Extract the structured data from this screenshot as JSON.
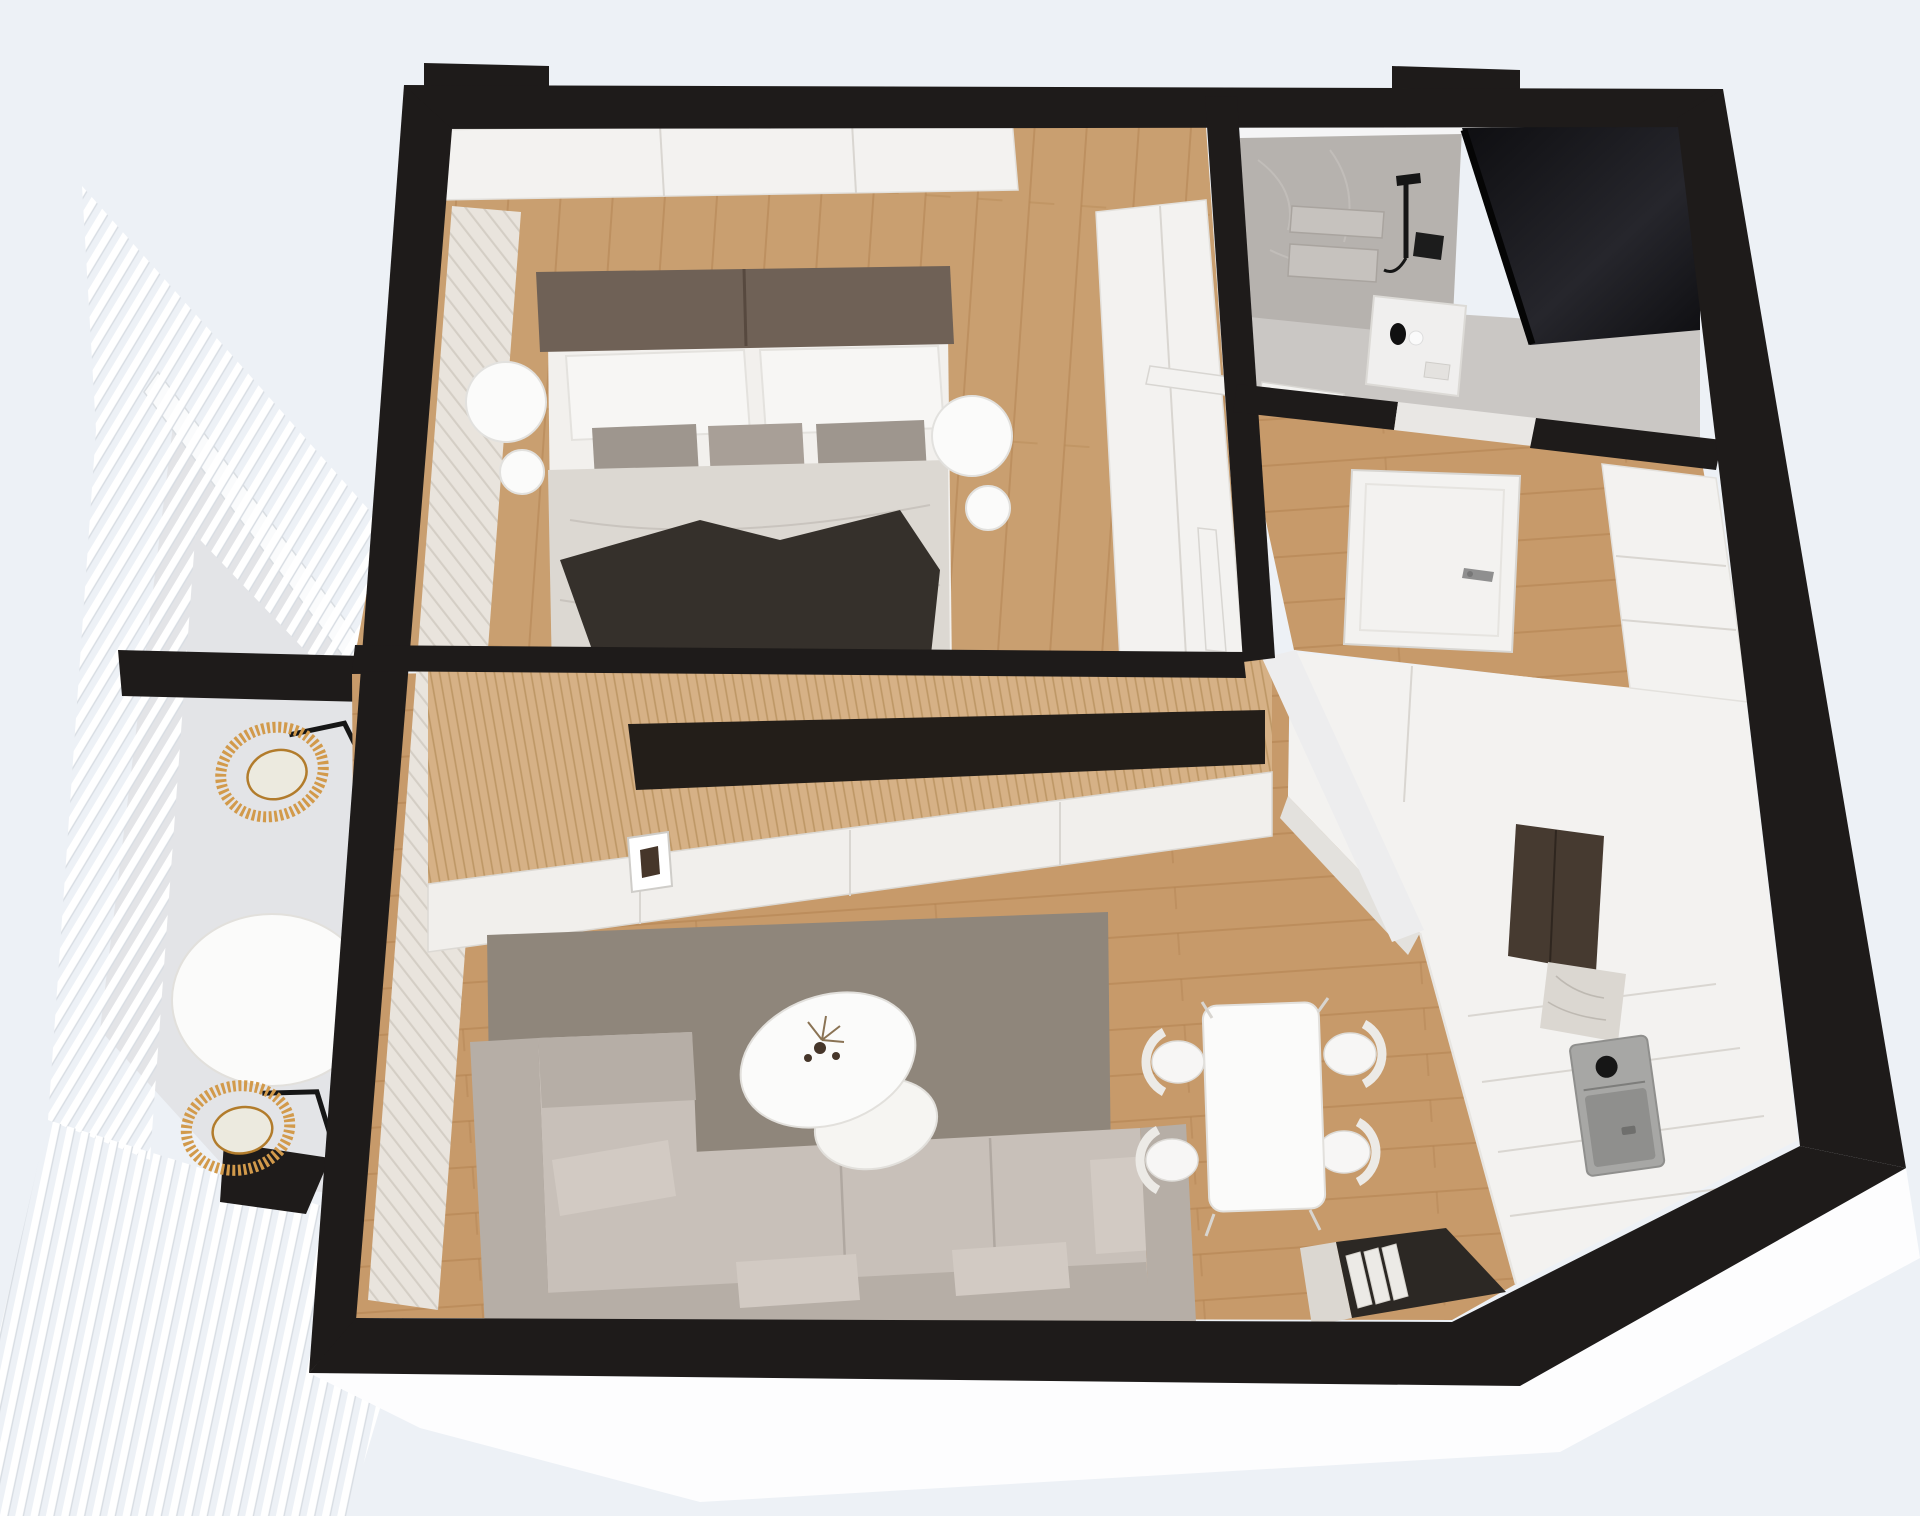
{
  "scene": {
    "kind": "3d-floor-plan-render",
    "view": "top-down axonometric",
    "apartment": "one-bedroom apartment with balcony"
  },
  "rooms": [
    {
      "id": "bedroom",
      "label": "Bedroom",
      "furniture": [
        "double-bed",
        "headboard",
        "white-pillows",
        "gray-pillows",
        "duvet",
        "dark-throw-blanket",
        "nightstand-left",
        "nightstand-right",
        "wardrobe-top-run",
        "wardrobe-side-column",
        "curtain"
      ]
    },
    {
      "id": "living-room",
      "label": "Living room",
      "furniture": [
        "corner-sofa",
        "area-rug",
        "organic-coffee-table",
        "dried-flower-decor",
        "wood-slat-tv-wall",
        "tv-niche",
        "tv-sideboard",
        "art-print"
      ]
    },
    {
      "id": "dining-area",
      "label": "Dining area",
      "furniture": [
        "dining-table",
        "dining-chair",
        "dining-chair",
        "dining-chair",
        "dining-chair"
      ]
    },
    {
      "id": "kitchen",
      "label": "Kitchen",
      "furniture": [
        "peninsula-block",
        "bronze-tall-cabinet",
        "marble-backsplash",
        "sink",
        "counter-run",
        "console-with-books"
      ]
    },
    {
      "id": "bathroom",
      "label": "Bathroom",
      "furniture": [
        "concrete-shower-wall",
        "shower-set",
        "shower-niche-shelves",
        "dark-glass-screen",
        "vanity",
        "toiletries"
      ]
    },
    {
      "id": "hallway",
      "label": "Hallway",
      "furniture": [
        "open-door",
        "door-frames",
        "storage-cabinets"
      ]
    },
    {
      "id": "balcony",
      "label": "Balcony",
      "furniture": [
        "pergola-slat-roof",
        "rattan-chair",
        "rattan-chair",
        "round-side-table"
      ]
    }
  ],
  "colors": {
    "background": "#edf1f6",
    "wallBlack": "#1e1b1a",
    "wallFaceWhite": "#fdfdfe",
    "woodFloor": "#c79a6a",
    "woodLine": "#b2824f",
    "woodFloorBedroom": "#c99f70",
    "balconyFloor": "#e3e4e7",
    "pergolaSlat": "#ffffff",
    "pergolaSlatEdge": "#d7dce2",
    "beamWhite": "#fafbfc",
    "beamEdge": "#d9dde1",
    "slatWood": "#d6b186",
    "slatWoodLine": "#bd9765",
    "tvNiche": "#231e19",
    "tvCabinet": "#f1efec",
    "cabinetSeam": "#d9d6d1",
    "rug": "#8f867b",
    "sofa": "#b6aea6",
    "sofaCushion": "#c8c0b9",
    "sofaPillow": "#d2cac3",
    "sofaShadow": "#a79f97",
    "curtain": "#e9e4dd",
    "curtainFold": "#cfc8bf",
    "bedHeadboard": "#6f6156",
    "bedBase": "#f2f0ed",
    "duvet": "#dcd8d2",
    "pillowWhite": "#f7f6f4",
    "pillowGray": "#9e968e",
    "pillowGray2": "#a89f97",
    "pillowDark": "#8d847c",
    "throwDark": "#35302b",
    "nightstand": "#fbfbfa",
    "kitchenWhite": "#f3f2f0",
    "kitchenShade": "#e3e1dd",
    "bronze": "#463a30",
    "bronzeSeam": "#2f261f",
    "marble": "#dbd7d1",
    "marbleVein": "#b6b1aa",
    "sink": "#a7a7a5",
    "sinkInner": "#8f8f8d",
    "metalBlack": "#161616",
    "chrome": "#8f8f8f",
    "concrete": "#b6b2ae",
    "concreteLight": "#c6c2be",
    "glassDark": "#0e0e11",
    "glassDark2": "#26262c",
    "bathFloor": "#cac7c4",
    "bathCap": "#f5f5f6",
    "vanityWhite": "#f0efee",
    "door": "#f3f2f0",
    "doorEdge": "#d8d6d2",
    "thresholdLight": "#e9e7e4",
    "rattan": "#d29a4b",
    "rattanDark": "#b27c2c",
    "chairWhite": "#f7f6f5",
    "chairBack": "#eceae6",
    "tableWhite": "#fbfbfa",
    "tableStroke": "#e2e0dc",
    "consoleDark": "#2c2824",
    "bookWhite": "#eceae6",
    "flowerDark": "#46362a",
    "flowerTan": "#8a7354"
  }
}
